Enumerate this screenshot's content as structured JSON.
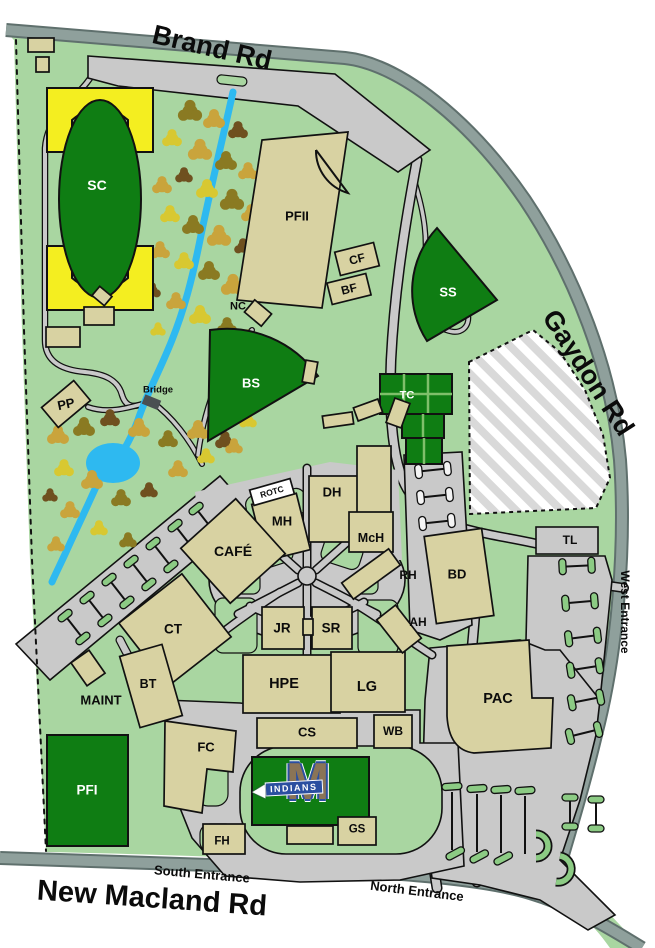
{
  "roads": {
    "brand": "Brand Rd",
    "gaydon": "Gaydon Rd",
    "new_macland": "New Macland Rd"
  },
  "entrances": {
    "south": "South Entrance",
    "north": "North Entrance",
    "west": "West Entrance"
  },
  "locations": {
    "sc": "SC",
    "pfii": "PFII",
    "cf": "CF",
    "bf": "BF",
    "ss": "SS",
    "nc": "NC",
    "bs": "BS",
    "tc": "TC",
    "pp": "PP",
    "bridge": "Bridge",
    "rotc": "ROTC",
    "mh": "MH",
    "dh": "DH",
    "mch": "McH",
    "cafe": "CAFÉ",
    "rh": "RH",
    "bd": "BD",
    "tl": "TL",
    "ct": "CT",
    "jr": "JR",
    "sr": "SR",
    "ah": "AH",
    "maint": "MAINT",
    "bt": "BT",
    "hpe": "HPE",
    "lg": "LG",
    "fc": "FC",
    "cs": "CS",
    "wb": "WB",
    "pac": "PAC",
    "pfi": "PFI",
    "fh": "FH",
    "gs": "GS"
  },
  "logo": {
    "letter": "M",
    "team": "INDIANS"
  },
  "colors": {
    "campus_green": "#A9D6A1",
    "field_green": "#0F7D13",
    "stadium_yellow": "#F4EE20",
    "building_tan": "#D8D2A2",
    "road_gray": "#8FA09C",
    "road_edge": "#5F706D",
    "parking_gray": "#C9C9C9",
    "creek_blue": "#2EB9F0",
    "logo_blue": "#2B4FA0",
    "logo_brown": "#8A7456"
  }
}
